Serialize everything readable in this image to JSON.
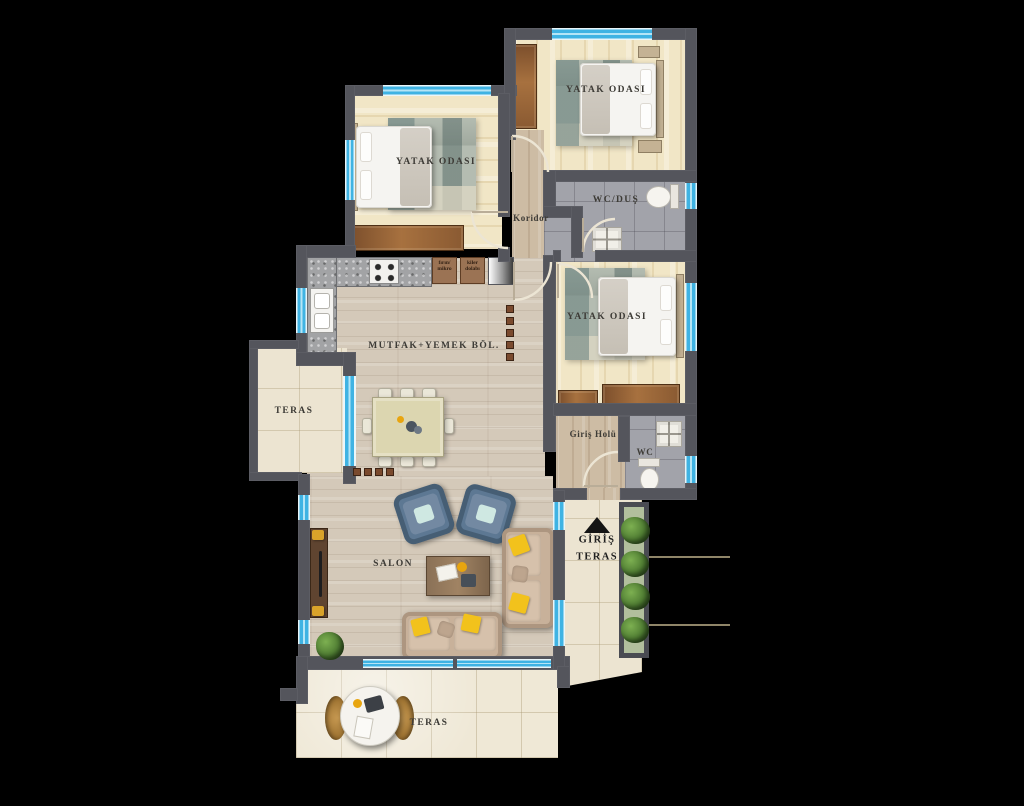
{
  "plan": {
    "background_color": "#000000",
    "wall_color": "#54555c",
    "window_color": "#3fb3e3"
  },
  "labels": {
    "bedroom_top_left": "YATAK ODASI",
    "bedroom_top_right": "YATAK ODASI",
    "bedroom_right": "YATAK ODASI",
    "corridor": "Koridor",
    "bathroom": "WC/DUŞ",
    "kitchen_dining": "MUTFAK+YEMEK BÖL.",
    "terrace_left": "TERAS",
    "entry_hall": "Giriş Holü",
    "wc": "WC",
    "living_room": "SALON",
    "entrance": "GİRİŞ",
    "entrance_terrace": "TERAS",
    "terrace_bottom": "TERAS",
    "oven_micro_line1": "fırın/",
    "oven_micro_line2": "mikro",
    "pantry_line1": "kiler",
    "pantry_line2": "dolabı"
  }
}
